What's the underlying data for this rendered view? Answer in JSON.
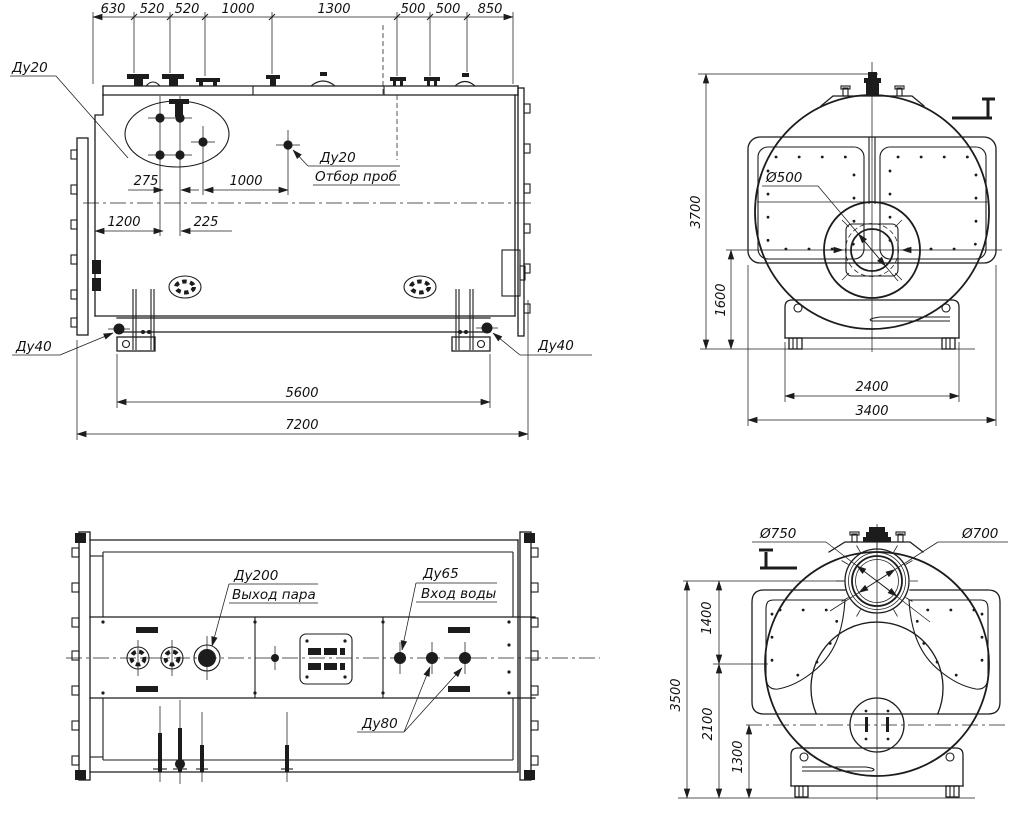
{
  "drawing_type": "boiler-general-arrangement",
  "colors": {
    "line": "#1c1c1c",
    "background": "#ffffff"
  },
  "views": {
    "side": {
      "top_dims": [
        "630",
        "520",
        "520",
        "1000",
        "1300",
        "500",
        "500",
        "850"
      ],
      "du20": "Ду20",
      "otbor_size": "Ду20",
      "otbor_name": "Отбор проб",
      "d275": "275",
      "d1000": "1000",
      "d1200": "1200",
      "d225": "225",
      "du40_left": "Ду40",
      "du40_right": "Ду40",
      "d5600": "5600",
      "d7200": "7200"
    },
    "front": {
      "d3700": "3700",
      "d1600": "1600",
      "d500": "Ø500",
      "d2400": "2400",
      "d3400": "3400"
    },
    "plan": {
      "du200": "Ду200",
      "steam_out": "Выход пара",
      "du65": "Ду65",
      "water_in": "Вход воды",
      "du80": "Ду80"
    },
    "rear": {
      "d750": "Ø750",
      "d700": "Ø700",
      "d1400": "1400",
      "d3500": "3500",
      "d2100": "2100",
      "d1300": "1300"
    }
  }
}
